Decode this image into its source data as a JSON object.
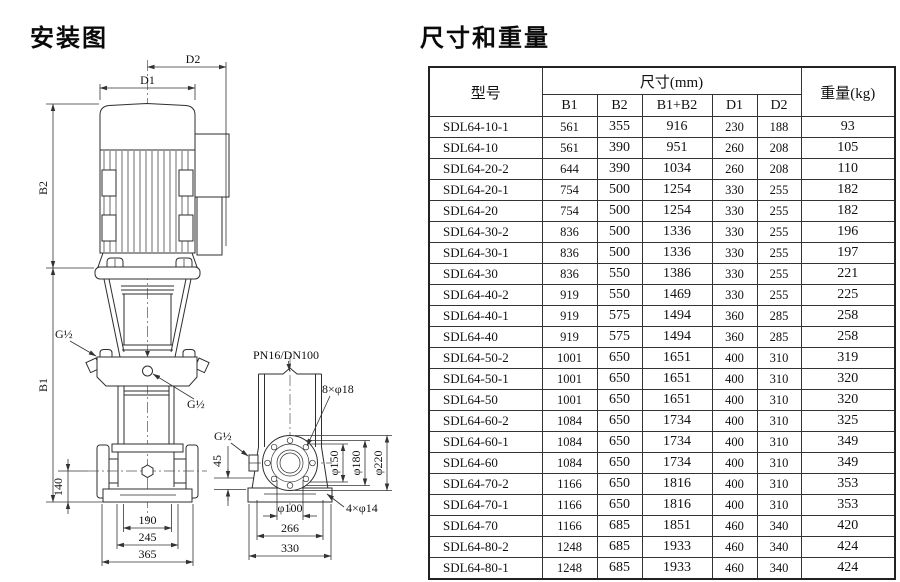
{
  "left": {
    "title": "安装图",
    "diagram": {
      "labels": {
        "D1": "D1",
        "D2": "D2",
        "B1": "B1",
        "B2": "B2",
        "g_half_top": "G½",
        "g_half_mid": "G½",
        "g_half_side": "G½",
        "pn": "PN16/DN100",
        "bolts_flange": "8×φ18",
        "bolts_base": "4×φ14",
        "phi150": "φ150",
        "phi180": "φ180",
        "phi220": "φ220",
        "phi100": "φ100",
        "dim45": "45",
        "dim140": "140",
        "dim190": "190",
        "dim245": "245",
        "dim365": "365",
        "dim266": "266",
        "dim330": "330"
      }
    }
  },
  "right": {
    "title": "尺寸和重量",
    "table": {
      "header": {
        "model": "型号",
        "size_group": "尺寸(mm)",
        "weight": "重量(kg)",
        "size_cols": [
          "B1",
          "B2",
          "B1+B2",
          "D1",
          "D2"
        ]
      },
      "rows": [
        [
          "SDL64-10-1",
          "561",
          "355",
          "916",
          "230",
          "188",
          "93"
        ],
        [
          "SDL64-10",
          "561",
          "390",
          "951",
          "260",
          "208",
          "105"
        ],
        [
          "SDL64-20-2",
          "644",
          "390",
          "1034",
          "260",
          "208",
          "110"
        ],
        [
          "SDL64-20-1",
          "754",
          "500",
          "1254",
          "330",
          "255",
          "182"
        ],
        [
          "SDL64-20",
          "754",
          "500",
          "1254",
          "330",
          "255",
          "182"
        ],
        [
          "SDL64-30-2",
          "836",
          "500",
          "1336",
          "330",
          "255",
          "196"
        ],
        [
          "SDL64-30-1",
          "836",
          "500",
          "1336",
          "330",
          "255",
          "197"
        ],
        [
          "SDL64-30",
          "836",
          "550",
          "1386",
          "330",
          "255",
          "221"
        ],
        [
          "SDL64-40-2",
          "919",
          "550",
          "1469",
          "330",
          "255",
          "225"
        ],
        [
          "SDL64-40-1",
          "919",
          "575",
          "1494",
          "360",
          "285",
          "258"
        ],
        [
          "SDL64-40",
          "919",
          "575",
          "1494",
          "360",
          "285",
          "258"
        ],
        [
          "SDL64-50-2",
          "1001",
          "650",
          "1651",
          "400",
          "310",
          "319"
        ],
        [
          "SDL64-50-1",
          "1001",
          "650",
          "1651",
          "400",
          "310",
          "320"
        ],
        [
          "SDL64-50",
          "1001",
          "650",
          "1651",
          "400",
          "310",
          "320"
        ],
        [
          "SDL64-60-2",
          "1084",
          "650",
          "1734",
          "400",
          "310",
          "325"
        ],
        [
          "SDL64-60-1",
          "1084",
          "650",
          "1734",
          "400",
          "310",
          "349"
        ],
        [
          "SDL64-60",
          "1084",
          "650",
          "1734",
          "400",
          "310",
          "349"
        ],
        [
          "SDL64-70-2",
          "1166",
          "650",
          "1816",
          "400",
          "310",
          "353"
        ],
        [
          "SDL64-70-1",
          "1166",
          "650",
          "1816",
          "400",
          "310",
          "353"
        ],
        [
          "SDL64-70",
          "1166",
          "685",
          "1851",
          "460",
          "340",
          "420"
        ],
        [
          "SDL64-80-2",
          "1248",
          "685",
          "1933",
          "460",
          "340",
          "424"
        ],
        [
          "SDL64-80-1",
          "1248",
          "685",
          "1933",
          "460",
          "340",
          "424"
        ]
      ]
    }
  }
}
